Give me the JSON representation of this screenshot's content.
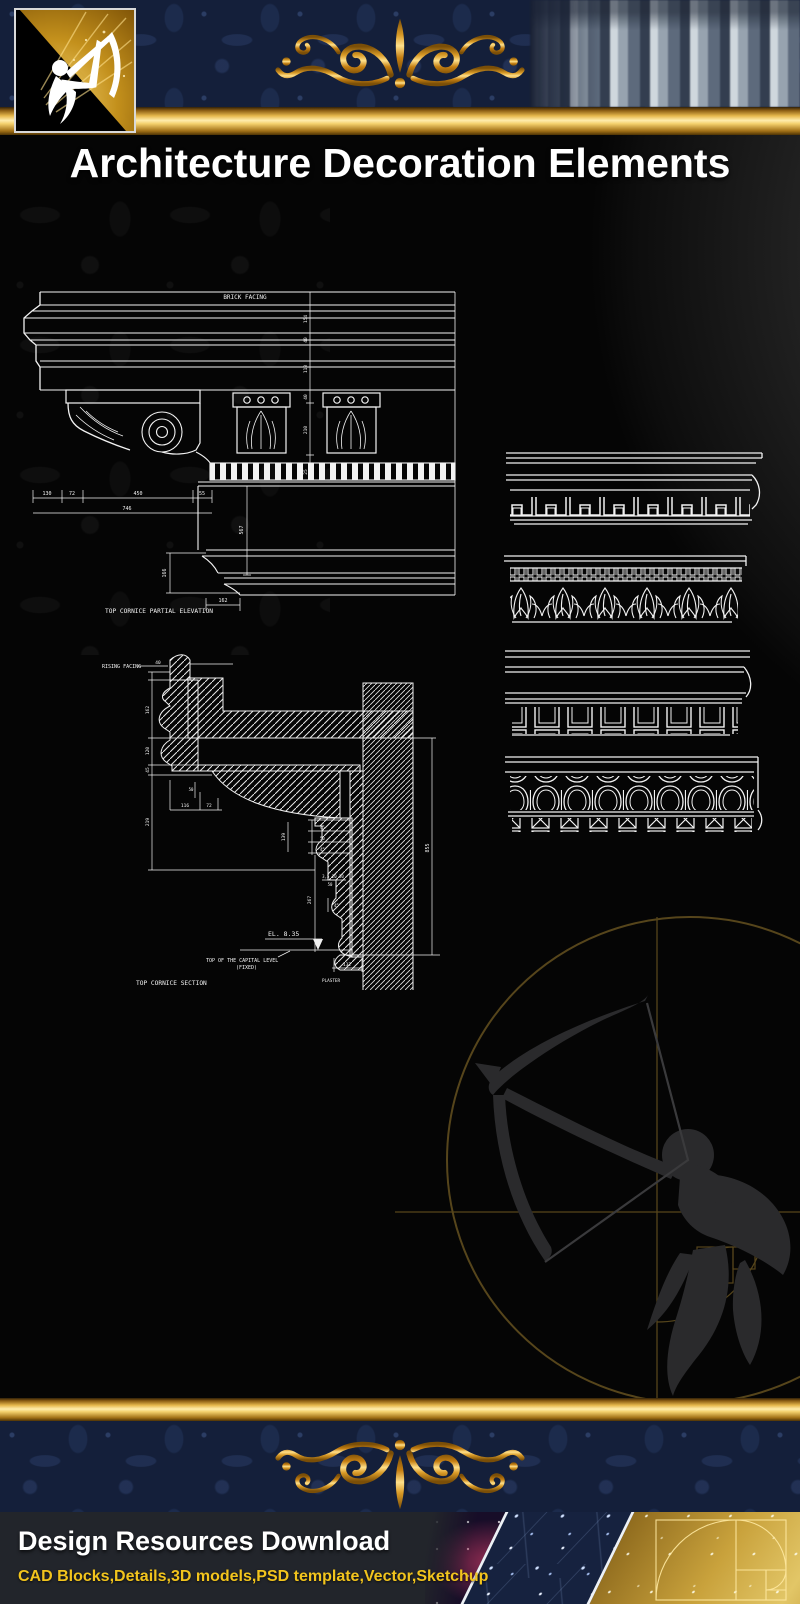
{
  "header": {
    "title": "Architecture Decoration Elements"
  },
  "icons": {
    "logo": "archer-gold-square",
    "banner_ornament": "gold-fleur-flourish",
    "footer_ornament": "gold-fleur-flourish-inverted",
    "banner_photo": "classical-columns-colonnade",
    "watermark": "archer-with-golden-ratio-circle",
    "collage": "nebula-network-golden-spiral"
  },
  "cad": {
    "elevation": {
      "facing_label": "BRICK FACING",
      "caption": "TOP CORNICE PARTIAL ELEVATION",
      "hdims": [
        "130",
        "72",
        "450",
        "55"
      ],
      "total_width": "746",
      "vdims": [
        "154",
        "40",
        "110",
        "40",
        "210",
        "25"
      ],
      "side_height": "567",
      "crown_height": "166",
      "base_dim": "162"
    },
    "section": {
      "facing_label": "RISING FACING",
      "caption": "TOP CORNICE SECTION",
      "top_dim": "40",
      "left_vdims": [
        "162",
        "120",
        "45",
        "219"
      ],
      "hdims": [
        "116",
        "72"
      ],
      "hdim_small": "50",
      "mid_vdims": [
        "45",
        "50",
        "45",
        "139",
        "267",
        "45"
      ],
      "mid_row": "3,5 20 30",
      "mid_row2": "50",
      "bottom_dim": "132",
      "right_height": "855",
      "level_label": "EL. 8.35",
      "capital_label": "TOP OF THE CAPITAL LEVEL",
      "capital_label2": "(FIXED)",
      "plaster_label": "PLASTER"
    }
  },
  "footer": {
    "heading": "Design Resources Download",
    "tagline": "CAD Blocks,Details,3D models,PSD template,Vector,Sketchup"
  },
  "colors": {
    "gold_bar": "#e8b84b",
    "navy_band": "#141f3a",
    "cad_line": "#f2f2f2",
    "tagline_gold": "#f2c41d",
    "title_white": "#ffffff"
  }
}
